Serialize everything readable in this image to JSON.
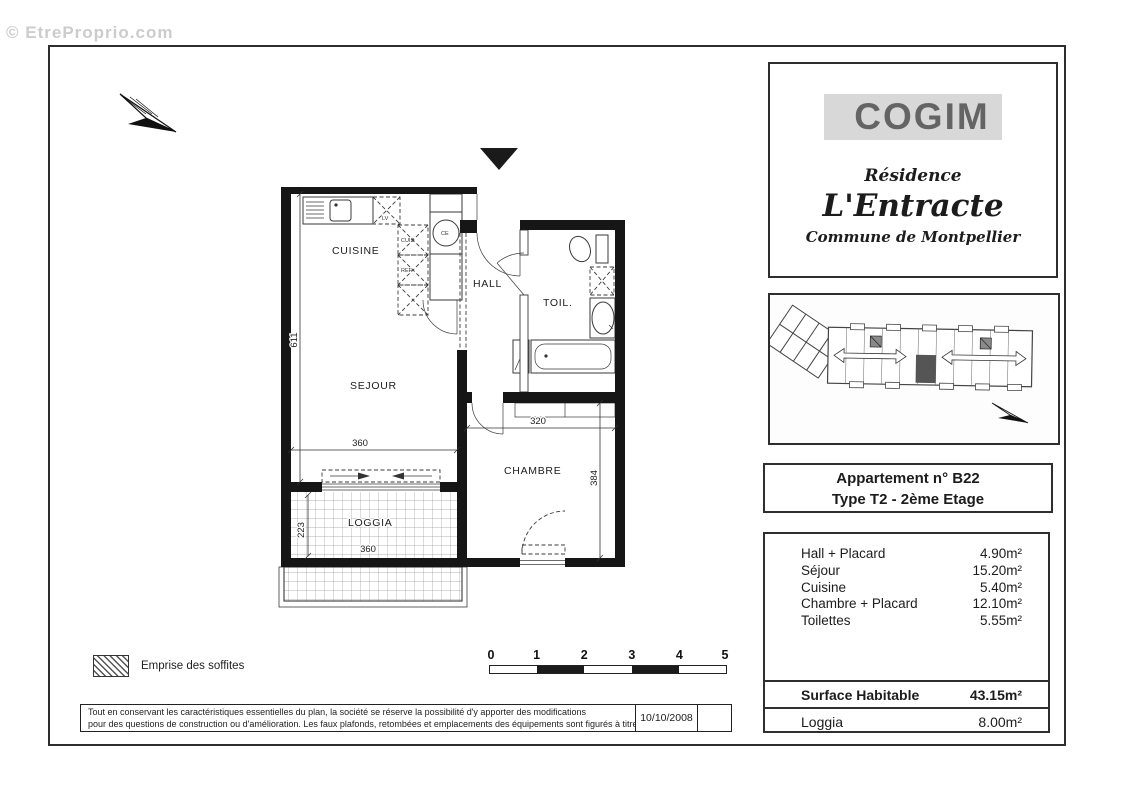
{
  "watermark": "© EtreProprio.com",
  "brand_box": {
    "logo": "COGIM",
    "residence_label": "Résidence",
    "residence_name": "L'Entracte",
    "commune": "Commune de Montpellier"
  },
  "apartment_box": {
    "line1": "Appartement n° B22",
    "line2": "Type T2 -  2ème Etage"
  },
  "areas_table": {
    "rows": [
      {
        "label": "Hall + Placard",
        "value": "4.90m²"
      },
      {
        "label": "Séjour",
        "value": "15.20m²"
      },
      {
        "label": "Cuisine",
        "value": "5.40m²"
      },
      {
        "label": "Chambre + Placard",
        "value": "12.10m²"
      },
      {
        "label": "Toilettes",
        "value": "5.55m²"
      }
    ],
    "surface_label": "Surface Habitable",
    "surface_value": "43.15m²",
    "loggia_label": "Loggia",
    "loggia_value": "8.00m²"
  },
  "floor_plan": {
    "rooms": {
      "cuisine": "CUISINE",
      "hall": "HALL",
      "toilettes": "TOIL.",
      "sejour": "SEJOUR",
      "chambre": "CHAMBRE",
      "loggia": "LOGGIA"
    },
    "fixtures": {
      "lv": "LV",
      "cuis": "CUIS",
      "ref": "REF",
      "ce": "CE"
    },
    "dimensions": {
      "left_wall": "611",
      "sejour_width": "360",
      "chambre_width": "320",
      "chambre_height": "384",
      "loggia_depth": "223",
      "loggia_width": "360"
    }
  },
  "legend": {
    "soffits": "Emprise des soffites"
  },
  "scale_bar": {
    "ticks": [
      "0",
      "1",
      "2",
      "3",
      "4",
      "5"
    ]
  },
  "footer": {
    "disclaimer_line1": "Tout en conservant les caractéristiques essentielles du plan, la société se réserve la possibilité d'y apporter des modifications",
    "disclaimer_line2": "pour des questions de construction ou d'amélioration. Les faux plafonds, retombées et emplacements des équipements sont figurés à titre indicatif",
    "date": "10/10/2008"
  }
}
